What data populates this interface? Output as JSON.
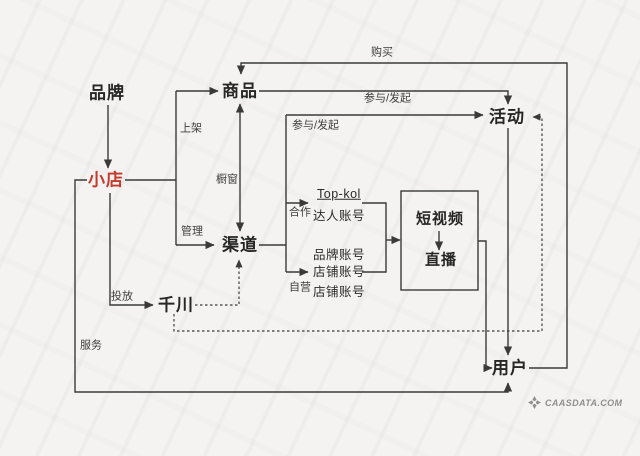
{
  "nodes": {
    "brand": "品牌",
    "shop": "小店",
    "product": "商品",
    "channel": "渠道",
    "qianchuan": "千川",
    "activity": "活动",
    "user": "用户",
    "short_video": "短视频",
    "live": "直播"
  },
  "accounts": {
    "top_kol": "Top-kol",
    "influencer": "达人账号",
    "brand_account": "品牌账号",
    "shop_account_1": "店铺账号",
    "shop_account_2": "店铺账号"
  },
  "edge_labels": {
    "buy": "购买",
    "listing": "上架",
    "showcase": "橱窗",
    "manage": "管理",
    "invest": "投放",
    "service": "服务",
    "participate_initiate_top": "参与/发起",
    "participate_initiate_left": "参与/发起",
    "cooperation": "合作",
    "self_operated": "自营"
  },
  "branding": {
    "watermark": "CAASDATA.COM"
  },
  "colors": {
    "highlight_red": "#c43a2d",
    "line": "#3a3a3a",
    "background": "#f4f3f1"
  }
}
